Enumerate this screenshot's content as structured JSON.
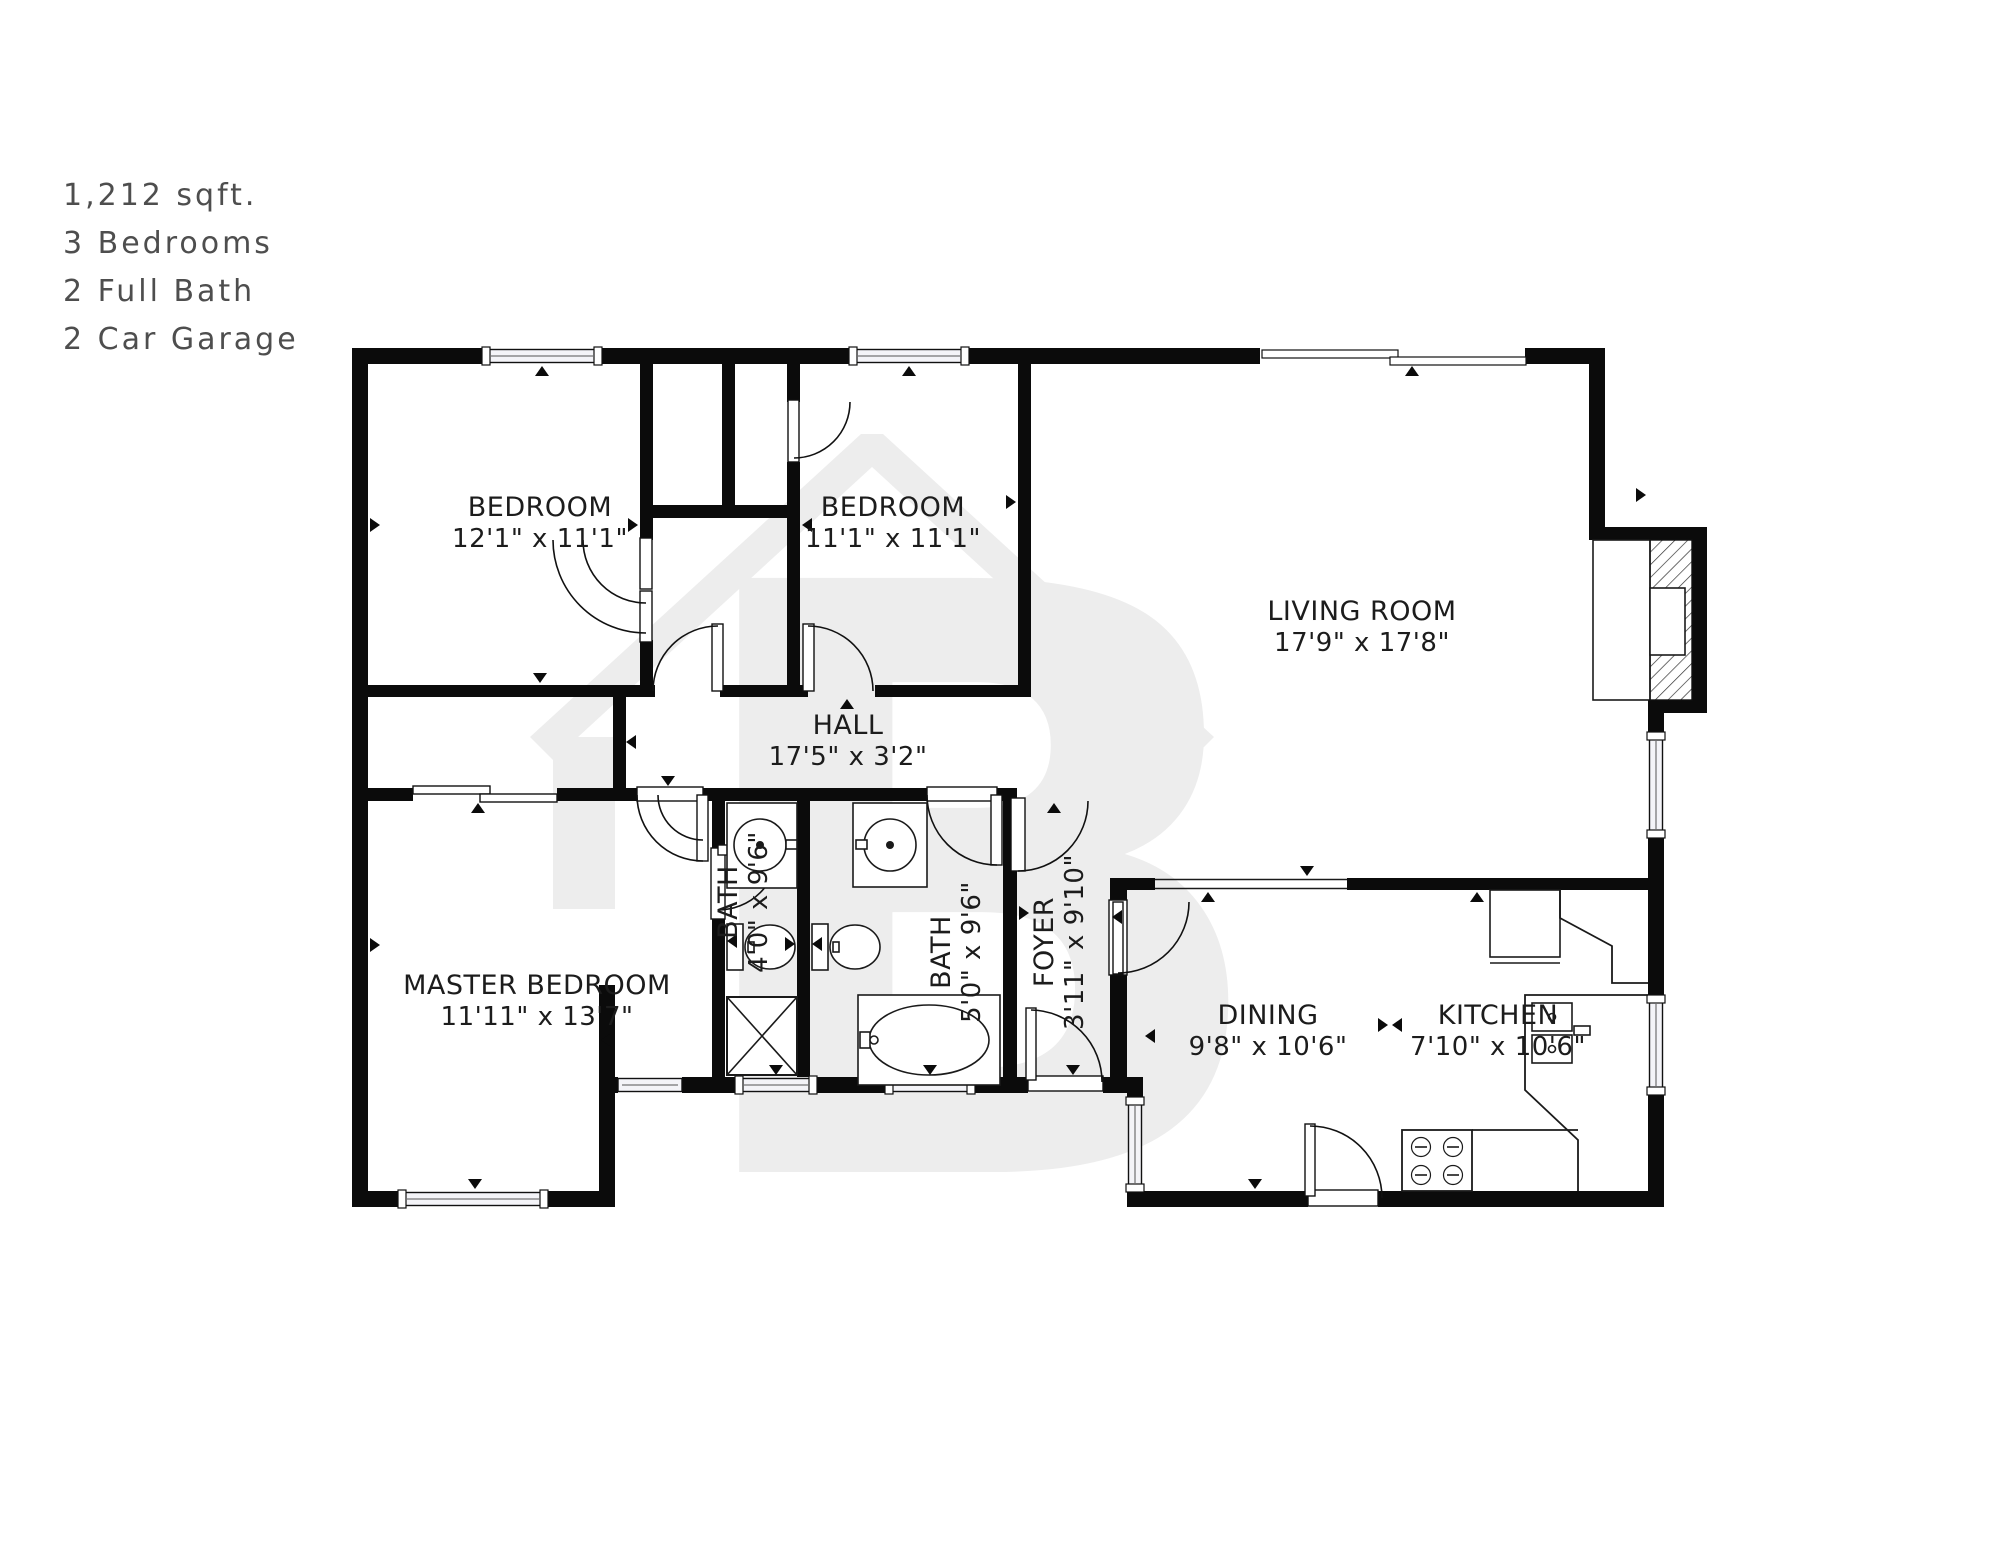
{
  "info_panel": {
    "lines": [
      "1,212 sqft.",
      "3 Bedrooms",
      "2 Full Bath",
      "2 Car Garage"
    ]
  },
  "watermark": {
    "letter": "B",
    "color": "#ededed"
  },
  "palette": {
    "wall": "#0b0b0b",
    "text": "#1c1c1c",
    "info_text": "#4e4e4e",
    "window_fill": "#f4f4f8"
  },
  "rooms": [
    {
      "id": "bedroom-1",
      "name": "BEDROOM",
      "dims": "12'1\" x 11'1\"",
      "x": 540,
      "y": 516,
      "rot": 0
    },
    {
      "id": "bedroom-2",
      "name": "BEDROOM",
      "dims": "11'1\" x 11'1\"",
      "x": 893,
      "y": 516,
      "rot": 0
    },
    {
      "id": "living-room",
      "name": "LIVING ROOM",
      "dims": "17'9\" x 17'8\"",
      "x": 1362,
      "y": 620,
      "rot": 0
    },
    {
      "id": "hall",
      "name": "HALL",
      "dims": "17'5\" x 3'2\"",
      "x": 848,
      "y": 734,
      "rot": 0
    },
    {
      "id": "master-bedroom",
      "name": "MASTER BEDROOM",
      "dims": "11'11\" x 13'7\"",
      "x": 537,
      "y": 994,
      "rot": 0
    },
    {
      "id": "bath-1",
      "name": "BATH",
      "dims": "4'0\" x 9'6\"",
      "x": 737,
      "y": 902,
      "rot": -90
    },
    {
      "id": "bath-2",
      "name": "BATH",
      "dims": "5'0\" x 9'6\"",
      "x": 950,
      "y": 952,
      "rot": -90
    },
    {
      "id": "foyer",
      "name": "FOYER",
      "dims": "3'11\" x 9'10\"",
      "x": 1053,
      "y": 942,
      "rot": -90
    },
    {
      "id": "dining",
      "name": "DINING",
      "dims": "9'8\" x 10'6\"",
      "x": 1268,
      "y": 1024,
      "rot": 0
    },
    {
      "id": "kitchen",
      "name": "KITCHEN",
      "dims": "7'10\" x 10'6\"",
      "x": 1498,
      "y": 1024,
      "rot": 0
    }
  ]
}
